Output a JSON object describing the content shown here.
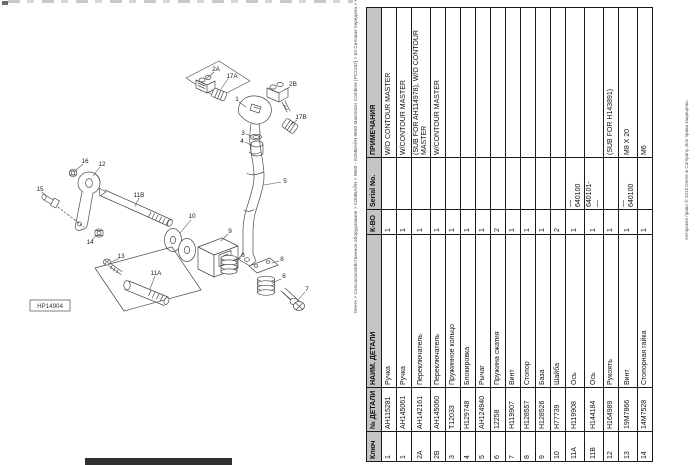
{
  "page": {
    "title_vertical": "Deere > Сельскохозяйственное оборудование > КОМБАЙН > 9600 - КОМБАЙН 9600 Maximizer Combine [PC2182] > 50 Силовая передача > Hydrostatic Drive Lever, Cable and Switch - 37600886",
    "copyright_vertical": "Авторское право © 2019 Deere & Company. Все права защищены.",
    "figure_id": "HP14904"
  },
  "table": {
    "headers": {
      "key": "Ключ",
      "part": "№ ДЕТАЛИ",
      "name": "НАИМ. ДЕТАЛИ",
      "qty": "К-ВО",
      "serial": "Serial No.",
      "remarks": "ПРИМЕЧАНИЯ"
    },
    "rows": [
      {
        "key": "1",
        "part": "AH115281",
        "name": "Ручка",
        "qty": "1",
        "serial": "",
        "remarks": "W/O CONTOUR MASTER"
      },
      {
        "key": "1",
        "part": "AH145061",
        "name": "Ручка",
        "qty": "1",
        "serial": "",
        "remarks": "W/CONTOUR MASTER"
      },
      {
        "key": "2A",
        "part": "AH142161",
        "name": "Переключатель",
        "qty": "1",
        "serial": "",
        "remarks": "(SUB FOR AH114978), W/O CONTOUR MASTER"
      },
      {
        "key": "2B",
        "part": "AH145060",
        "name": "Переключатель",
        "qty": "1",
        "serial": "",
        "remarks": "W/CONTOUR MASTER"
      },
      {
        "key": "3",
        "part": "T12033",
        "name": "Пружинное кольцо",
        "qty": "1",
        "serial": "",
        "remarks": ""
      },
      {
        "key": "4",
        "part": "H129748",
        "name": "Блокировка",
        "qty": "1",
        "serial": "",
        "remarks": ""
      },
      {
        "key": "5",
        "part": "AH124940",
        "name": "Рычаг",
        "qty": "1",
        "serial": "",
        "remarks": ""
      },
      {
        "key": "6",
        "part": "12258",
        "name": "Пружина сжатия",
        "qty": "2",
        "serial": "",
        "remarks": ""
      },
      {
        "key": "7",
        "part": "H119907",
        "name": "Винт",
        "qty": "1",
        "serial": "",
        "remarks": ""
      },
      {
        "key": "8",
        "part": "H128557",
        "name": "Стопор",
        "qty": "1",
        "serial": "",
        "remarks": ""
      },
      {
        "key": "9",
        "part": "H128526",
        "name": "База",
        "qty": "1",
        "serial": "",
        "remarks": ""
      },
      {
        "key": "10",
        "part": "H77739",
        "name": "Шайба",
        "qty": "2",
        "serial": "",
        "remarks": ""
      },
      {
        "key": "11A",
        "part": "H119908",
        "name": "Ось",
        "qty": "1",
        "serial": "—\n640100",
        "remarks": ""
      },
      {
        "key": "11B",
        "part": "H144184",
        "name": "Ось",
        "qty": "1",
        "serial": "640101-\n—",
        "remarks": ""
      },
      {
        "key": "12",
        "part": "H164989",
        "name": "Рукоять",
        "qty": "1",
        "serial": "",
        "remarks": "(SUB FOR H143891)"
      },
      {
        "key": "13",
        "part": "19M7866",
        "name": "Винт",
        "qty": "1",
        "serial": "—\n640100",
        "remarks": "M8 X 20"
      },
      {
        "key": "14",
        "part": "14M7528",
        "name": "Стопорная гайка",
        "qty": "1",
        "serial": "",
        "remarks": "M6"
      }
    ]
  },
  "diagram": {
    "callouts": {
      "k1": "1",
      "k2a": "2A",
      "k17a": "17A",
      "k2b": "2B",
      "k17b": "17B",
      "k3": "3",
      "k4": "4",
      "k5": "5",
      "k6a": "6",
      "k6b": "6",
      "k7": "7",
      "k8": "8",
      "k9": "9",
      "k10": "10",
      "k11a": "11A",
      "k11b": "11B",
      "k12": "12",
      "k13": "13",
      "k14": "14",
      "k15": "15",
      "k16": "16"
    }
  }
}
